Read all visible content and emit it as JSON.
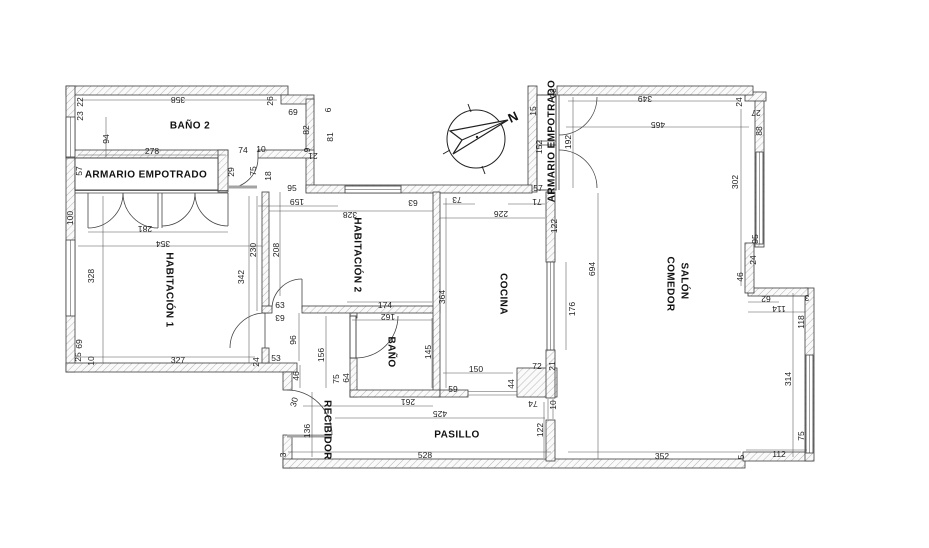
{
  "plan": {
    "type": "apartment-floor-plan",
    "colors": {
      "wall_line": "#3c3c3c",
      "hatch": "#b5b5b5",
      "door_leaf": "#a3a3a3",
      "dim_text": "#222222",
      "background": "#ffffff"
    },
    "rooms": [
      {
        "id": "bano2",
        "label": "BAÑO 2",
        "x": 190,
        "y": 126,
        "r": 0,
        "size": 10
      },
      {
        "id": "armario-empotrado-1",
        "label": "ARMARIO EMPOTRADO",
        "x": 146,
        "y": 175,
        "r": 0,
        "size": 9.5
      },
      {
        "id": "habitacion-1",
        "label": "HABITACIÓN 1",
        "x": 169,
        "y": 290,
        "r": 90,
        "size": 10
      },
      {
        "id": "habitacion-2",
        "label": "HABITACIÓN 2",
        "x": 357,
        "y": 255,
        "r": 90,
        "size": 10
      },
      {
        "id": "cocina",
        "label": "COCINA",
        "x": 503,
        "y": 294,
        "r": 90,
        "size": 10
      },
      {
        "id": "salon-line1",
        "label": "SALÓN",
        "x": 684,
        "y": 281,
        "r": 90,
        "size": 10
      },
      {
        "id": "salon-line2",
        "label": "COMEDOR",
        "x": 670,
        "y": 284,
        "r": 90,
        "size": 10
      },
      {
        "id": "bano",
        "label": "BAÑO",
        "x": 391,
        "y": 352,
        "r": 90,
        "size": 10
      },
      {
        "id": "recibidor",
        "label": "RECIBIDOR",
        "x": 327,
        "y": 430,
        "r": 90,
        "size": 9
      },
      {
        "id": "pasillo",
        "label": "PASILLO",
        "x": 457,
        "y": 435,
        "r": 0,
        "size": 10
      },
      {
        "id": "armario-empotrado-2",
        "label": "ARMARIO EMPOTRADO",
        "x": 552,
        "y": 141,
        "r": -90,
        "size": 7.5
      }
    ],
    "annotations": [
      {
        "id": "north",
        "label": "N",
        "x": 513,
        "y": 117,
        "r": -25,
        "cls": "note-label"
      }
    ],
    "dims": [
      {
        "v": "358",
        "x": 178,
        "y": 100,
        "r": 180
      },
      {
        "v": "22",
        "x": 80,
        "y": 102,
        "r": -90
      },
      {
        "v": "23",
        "x": 80,
        "y": 116,
        "r": -90
      },
      {
        "v": "94",
        "x": 106,
        "y": 139,
        "r": -90
      },
      {
        "v": "26",
        "x": 270,
        "y": 101,
        "r": -90
      },
      {
        "v": "69",
        "x": 293,
        "y": 112,
        "r": 0
      },
      {
        "v": "82",
        "x": 306,
        "y": 130,
        "r": -90
      },
      {
        "v": "6",
        "x": 328,
        "y": 110,
        "r": -90
      },
      {
        "v": "9",
        "x": 307,
        "y": 150,
        "r": -90
      },
      {
        "v": "21",
        "x": 313,
        "y": 156,
        "r": 180
      },
      {
        "v": "81",
        "x": 330,
        "y": 137,
        "r": -90
      },
      {
        "v": "278",
        "x": 152,
        "y": 151,
        "r": 0
      },
      {
        "v": "74",
        "x": 243,
        "y": 150,
        "r": 0
      },
      {
        "v": "10",
        "x": 261,
        "y": 149,
        "r": 0
      },
      {
        "v": "57",
        "x": 79,
        "y": 171,
        "r": -90
      },
      {
        "v": "29",
        "x": 231,
        "y": 172,
        "r": -90
      },
      {
        "v": "75",
        "x": 253,
        "y": 171,
        "r": -90
      },
      {
        "v": "18",
        "x": 268,
        "y": 176,
        "r": -90
      },
      {
        "v": "95",
        "x": 292,
        "y": 188,
        "r": 0
      },
      {
        "v": "159",
        "x": 297,
        "y": 202,
        "r": 180
      },
      {
        "v": "100",
        "x": 70,
        "y": 218,
        "r": -90
      },
      {
        "v": "281",
        "x": 145,
        "y": 229,
        "r": 180
      },
      {
        "v": "354",
        "x": 163,
        "y": 244,
        "r": 180
      },
      {
        "v": "328",
        "x": 91,
        "y": 276,
        "r": -90
      },
      {
        "v": "342",
        "x": 241,
        "y": 277,
        "r": -90
      },
      {
        "v": "230",
        "x": 253,
        "y": 250,
        "r": -90
      },
      {
        "v": "208",
        "x": 276,
        "y": 250,
        "r": -90
      },
      {
        "v": "69",
        "x": 79,
        "y": 344,
        "r": -90
      },
      {
        "v": "25",
        "x": 78,
        "y": 357,
        "r": -90
      },
      {
        "v": "10",
        "x": 91,
        "y": 361,
        "r": -90
      },
      {
        "v": "327",
        "x": 178,
        "y": 360,
        "r": 0
      },
      {
        "v": "24",
        "x": 256,
        "y": 362,
        "r": -90
      },
      {
        "v": "53",
        "x": 276,
        "y": 358,
        "r": 0
      },
      {
        "v": "63",
        "x": 280,
        "y": 305,
        "r": 0
      },
      {
        "v": "63",
        "x": 280,
        "y": 318,
        "r": 180
      },
      {
        "v": "96",
        "x": 293,
        "y": 340,
        "r": -90
      },
      {
        "v": "156",
        "x": 321,
        "y": 355,
        "r": -90
      },
      {
        "v": "46",
        "x": 296,
        "y": 376,
        "r": -90
      },
      {
        "v": "30",
        "x": 294,
        "y": 402,
        "r": -75
      },
      {
        "v": "136",
        "x": 307,
        "y": 431,
        "r": -90
      },
      {
        "v": "3",
        "x": 283,
        "y": 455,
        "r": -90
      },
      {
        "v": "75",
        "x": 336,
        "y": 379,
        "r": -90
      },
      {
        "v": "64",
        "x": 346,
        "y": 378,
        "r": -90
      },
      {
        "v": "328",
        "x": 350,
        "y": 215,
        "r": 180
      },
      {
        "v": "63",
        "x": 413,
        "y": 203,
        "r": 180
      },
      {
        "v": "174",
        "x": 385,
        "y": 305,
        "r": 0
      },
      {
        "v": "162",
        "x": 388,
        "y": 317,
        "r": 180
      },
      {
        "v": "364",
        "x": 442,
        "y": 297,
        "r": -90
      },
      {
        "v": "145",
        "x": 428,
        "y": 352,
        "r": -90
      },
      {
        "v": "73",
        "x": 457,
        "y": 200,
        "r": 180
      },
      {
        "v": "71",
        "x": 537,
        "y": 202,
        "r": 180
      },
      {
        "v": "226",
        "x": 501,
        "y": 214,
        "r": 180
      },
      {
        "v": "57",
        "x": 538,
        "y": 188,
        "r": 0
      },
      {
        "v": "122",
        "x": 554,
        "y": 226,
        "r": -90
      },
      {
        "v": "176",
        "x": 572,
        "y": 309,
        "r": -90
      },
      {
        "v": "694",
        "x": 592,
        "y": 269,
        "r": -90
      },
      {
        "v": "150",
        "x": 476,
        "y": 369,
        "r": 0
      },
      {
        "v": "72",
        "x": 537,
        "y": 366,
        "r": 0
      },
      {
        "v": "21",
        "x": 552,
        "y": 366,
        "r": -90
      },
      {
        "v": "44",
        "x": 511,
        "y": 384,
        "r": -90
      },
      {
        "v": "59",
        "x": 453,
        "y": 389,
        "r": 0
      },
      {
        "v": "74",
        "x": 533,
        "y": 404,
        "r": 180
      },
      {
        "v": "10",
        "x": 553,
        "y": 405,
        "r": -90
      },
      {
        "v": "261",
        "x": 408,
        "y": 402,
        "r": 180
      },
      {
        "v": "425",
        "x": 440,
        "y": 414,
        "r": 180
      },
      {
        "v": "528",
        "x": 425,
        "y": 455,
        "r": 0
      },
      {
        "v": "122",
        "x": 540,
        "y": 430,
        "r": -90
      },
      {
        "v": "28",
        "x": 553,
        "y": 93,
        "r": -90
      },
      {
        "v": "15",
        "x": 533,
        "y": 111,
        "r": -90
      },
      {
        "v": "152",
        "x": 539,
        "y": 147,
        "r": -90
      },
      {
        "v": "192",
        "x": 568,
        "y": 142,
        "r": -90
      },
      {
        "v": "349",
        "x": 645,
        "y": 99,
        "r": 180
      },
      {
        "v": "465",
        "x": 658,
        "y": 125,
        "r": 180
      },
      {
        "v": "24",
        "x": 739,
        "y": 102,
        "r": -90
      },
      {
        "v": "27",
        "x": 756,
        "y": 113,
        "r": 180
      },
      {
        "v": "88",
        "x": 759,
        "y": 131,
        "r": -90
      },
      {
        "v": "302",
        "x": 735,
        "y": 182,
        "r": -90
      },
      {
        "v": "95",
        "x": 755,
        "y": 239,
        "r": -90
      },
      {
        "v": "24",
        "x": 753,
        "y": 260,
        "r": -90
      },
      {
        "v": "46",
        "x": 740,
        "y": 277,
        "r": -90
      },
      {
        "v": "62",
        "x": 766,
        "y": 299,
        "r": 180
      },
      {
        "v": "114",
        "x": 779,
        "y": 309,
        "r": 180
      },
      {
        "v": "3",
        "x": 807,
        "y": 298,
        "r": 180
      },
      {
        "v": "118",
        "x": 801,
        "y": 322,
        "r": -90
      },
      {
        "v": "314",
        "x": 788,
        "y": 379,
        "r": -90
      },
      {
        "v": "75",
        "x": 801,
        "y": 436,
        "r": -90
      },
      {
        "v": "352",
        "x": 662,
        "y": 456,
        "r": 0
      },
      {
        "v": "112",
        "x": 779,
        "y": 454,
        "r": 0
      },
      {
        "v": "5",
        "x": 741,
        "y": 457,
        "r": -90
      }
    ]
  }
}
